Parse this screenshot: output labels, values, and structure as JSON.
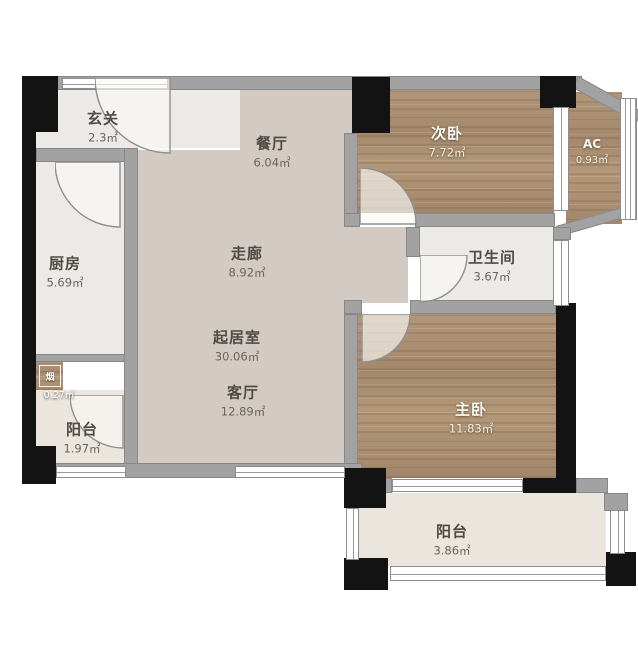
{
  "plan": {
    "rooms": {
      "entry": {
        "name": "玄关",
        "area": "2.3㎡"
      },
      "dining": {
        "name": "餐厅",
        "area": "6.04㎡"
      },
      "bedroom2": {
        "name": "次卧",
        "area": "7.72㎡"
      },
      "ac": {
        "name": "AC",
        "area": "0.93㎡"
      },
      "kitchen": {
        "name": "厨房",
        "area": "5.69㎡"
      },
      "corridor": {
        "name": "走廊",
        "area": "8.92㎡"
      },
      "bathroom": {
        "name": "卫生间",
        "area": "3.67㎡"
      },
      "living_suite": {
        "name": "起居室",
        "area": "30.06㎡"
      },
      "living_room": {
        "name": "客厅",
        "area": "12.89㎡"
      },
      "master": {
        "name": "主卧",
        "area": "11.83㎡"
      },
      "balcony_west": {
        "name": "阳台",
        "area": "1.97㎡"
      },
      "balcony_south": {
        "name": "阳台",
        "area": "3.86㎡"
      },
      "flue": {
        "name": "烟",
        "area": "0.27㎡"
      }
    },
    "colors": {
      "wood": "#ab8f72",
      "floor_main": "#d2cac3",
      "floor_light": "#eceae7",
      "floor_balcony": "#eae6dd",
      "wall": "#a2a2a2",
      "pillar": "#131313",
      "label_dark": "#4f4a44",
      "label_light": "#fbfaf7"
    }
  }
}
